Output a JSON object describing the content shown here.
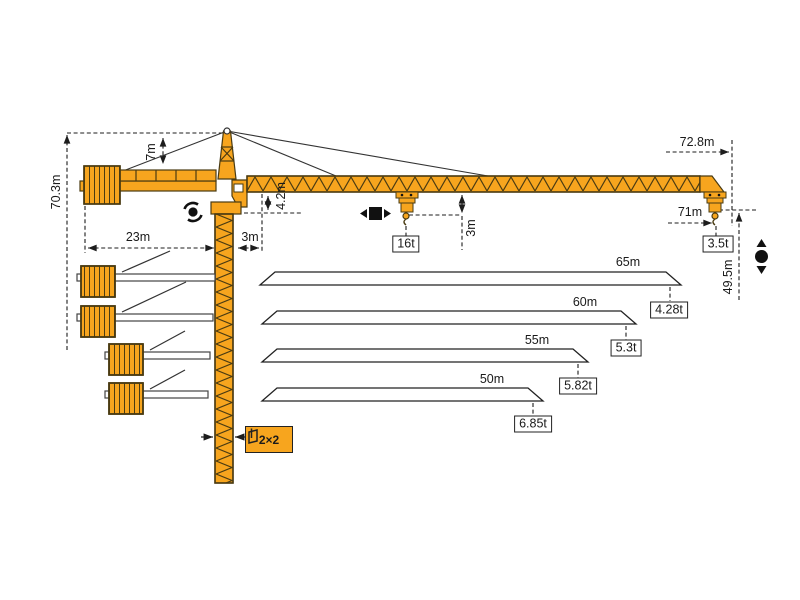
{
  "diagram": {
    "title": "tower-crane-specification-diagram",
    "colors": {
      "crane": "#F7A51E",
      "crane_outline": "#4A3B12",
      "line": "#1d1d1d"
    },
    "dims": {
      "total_height": "70.3m",
      "tower_top_height": "7m",
      "counterjib_radius": "23m",
      "min_radius": "3m",
      "jib_offset": "4.2m",
      "hook_clearance": "3m",
      "max_radius": "72.8m",
      "max_hook_radius": "71m",
      "hook_height": "49.5m",
      "mast_section": "2×2"
    },
    "loads": {
      "max_capacity": "16t",
      "tip_capacity": "3.5t"
    },
    "jib_configs": [
      {
        "length": "65m",
        "tip_capacity": "4.28t"
      },
      {
        "length": "60m",
        "tip_capacity": "5.3t"
      },
      {
        "length": "55m",
        "tip_capacity": "5.82t"
      },
      {
        "length": "50m",
        "tip_capacity": "6.85t"
      }
    ]
  }
}
